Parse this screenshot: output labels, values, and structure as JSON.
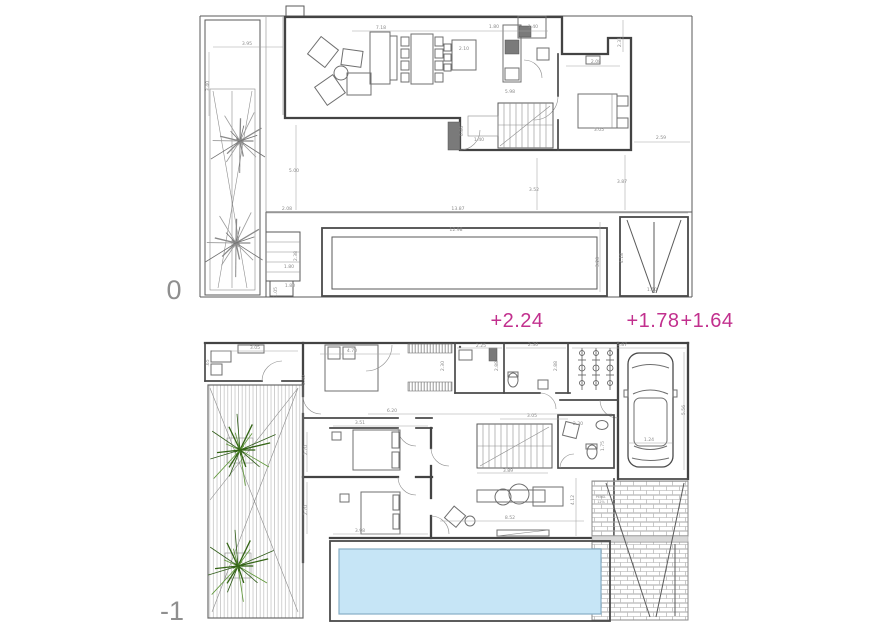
{
  "colors": {
    "wall": "#434343",
    "furniture": "#6f6f6f",
    "dim_text": "#8b8b8b",
    "magenta": "#c2308e",
    "pool_fill": "#c6e5f6",
    "pool_edge": "#86aec6",
    "plant_green_dark": "#336414",
    "plant_green_light": "#5d9636",
    "floor_label": "#8f8f8f",
    "brick": "#a5a5a5"
  },
  "floors": [
    {
      "label": "0"
    },
    {
      "label": "-1"
    }
  ],
  "elevations": [
    {
      "text": "+2.24",
      "x": 517,
      "y": 327
    },
    {
      "text": "+1.78",
      "x": 653,
      "y": 327
    },
    {
      "text": "+1.64",
      "x": 707,
      "y": 327
    }
  ],
  "plan0": {
    "dimensions": [
      [
        "3.95",
        247,
        45,
        0
      ],
      [
        "3.40",
        209,
        86,
        -90
      ],
      [
        "7.18",
        381,
        29,
        0
      ],
      [
        "1.80",
        494,
        28,
        0
      ],
      [
        "1.40",
        533,
        28,
        0
      ],
      [
        "2.10",
        464,
        50,
        0
      ],
      [
        "5.98",
        510,
        93,
        0
      ],
      [
        "2.31",
        621,
        42,
        -90
      ],
      [
        "2.08",
        596,
        63,
        0
      ],
      [
        "2.59",
        661,
        139,
        0
      ],
      [
        "3.05",
        599,
        131,
        0
      ],
      [
        "0.86",
        463,
        131,
        -90
      ],
      [
        "1.40",
        479,
        141,
        0
      ],
      [
        "5.00",
        294,
        172,
        0
      ],
      [
        "3.52",
        534,
        191,
        0
      ],
      [
        "3.87",
        622,
        183,
        0
      ],
      [
        "2.08",
        287,
        210,
        0
      ],
      [
        "13.87",
        458,
        210,
        0
      ],
      [
        "12.98",
        456,
        231,
        0
      ],
      [
        "2.38",
        297,
        256,
        -90
      ],
      [
        "1.80",
        289,
        268,
        0
      ],
      [
        "1.80",
        290,
        287,
        0
      ],
      [
        "1.05",
        277,
        292,
        -90
      ],
      [
        "3.20",
        599,
        262,
        -90
      ],
      [
        "4.18",
        623,
        258,
        -90
      ],
      [
        "1.50",
        652,
        291,
        0
      ]
    ]
  },
  "plan_minus1": {
    "dimensions": [
      [
        "3.05",
        255,
        349,
        0
      ],
      [
        ".65",
        209,
        363,
        -90
      ],
      [
        "4.70",
        352,
        352,
        0
      ],
      [
        "3.40",
        305,
        380,
        -90
      ],
      [
        "2.25",
        481,
        347,
        0
      ],
      [
        "2.30",
        533,
        346,
        0
      ],
      [
        "5.87",
        622,
        346,
        0
      ],
      [
        "2.30",
        444,
        366,
        -90
      ],
      [
        "2.88",
        498,
        366,
        -90
      ],
      [
        "2.88",
        557,
        366,
        -90
      ],
      [
        "6.20",
        392,
        412,
        0
      ],
      [
        "3.51",
        360,
        424,
        0
      ],
      [
        "2.70",
        307,
        450,
        -90
      ],
      [
        "2.70",
        307,
        510,
        -90
      ],
      [
        "3.05",
        532,
        417,
        0
      ],
      [
        "3.89",
        508,
        472,
        0
      ],
      [
        "2.30",
        578,
        425,
        0
      ],
      [
        "1.75",
        604,
        446,
        -90
      ],
      [
        "1.24",
        649,
        441,
        0
      ],
      [
        "5.56",
        685,
        410,
        -90
      ],
      [
        "8.52",
        510,
        519,
        0
      ],
      [
        "4.12",
        574,
        500,
        -90
      ],
      [
        "3.98",
        360,
        532,
        0
      ]
    ],
    "ramp_note": [
      "PEND.",
      "12%"
    ]
  }
}
